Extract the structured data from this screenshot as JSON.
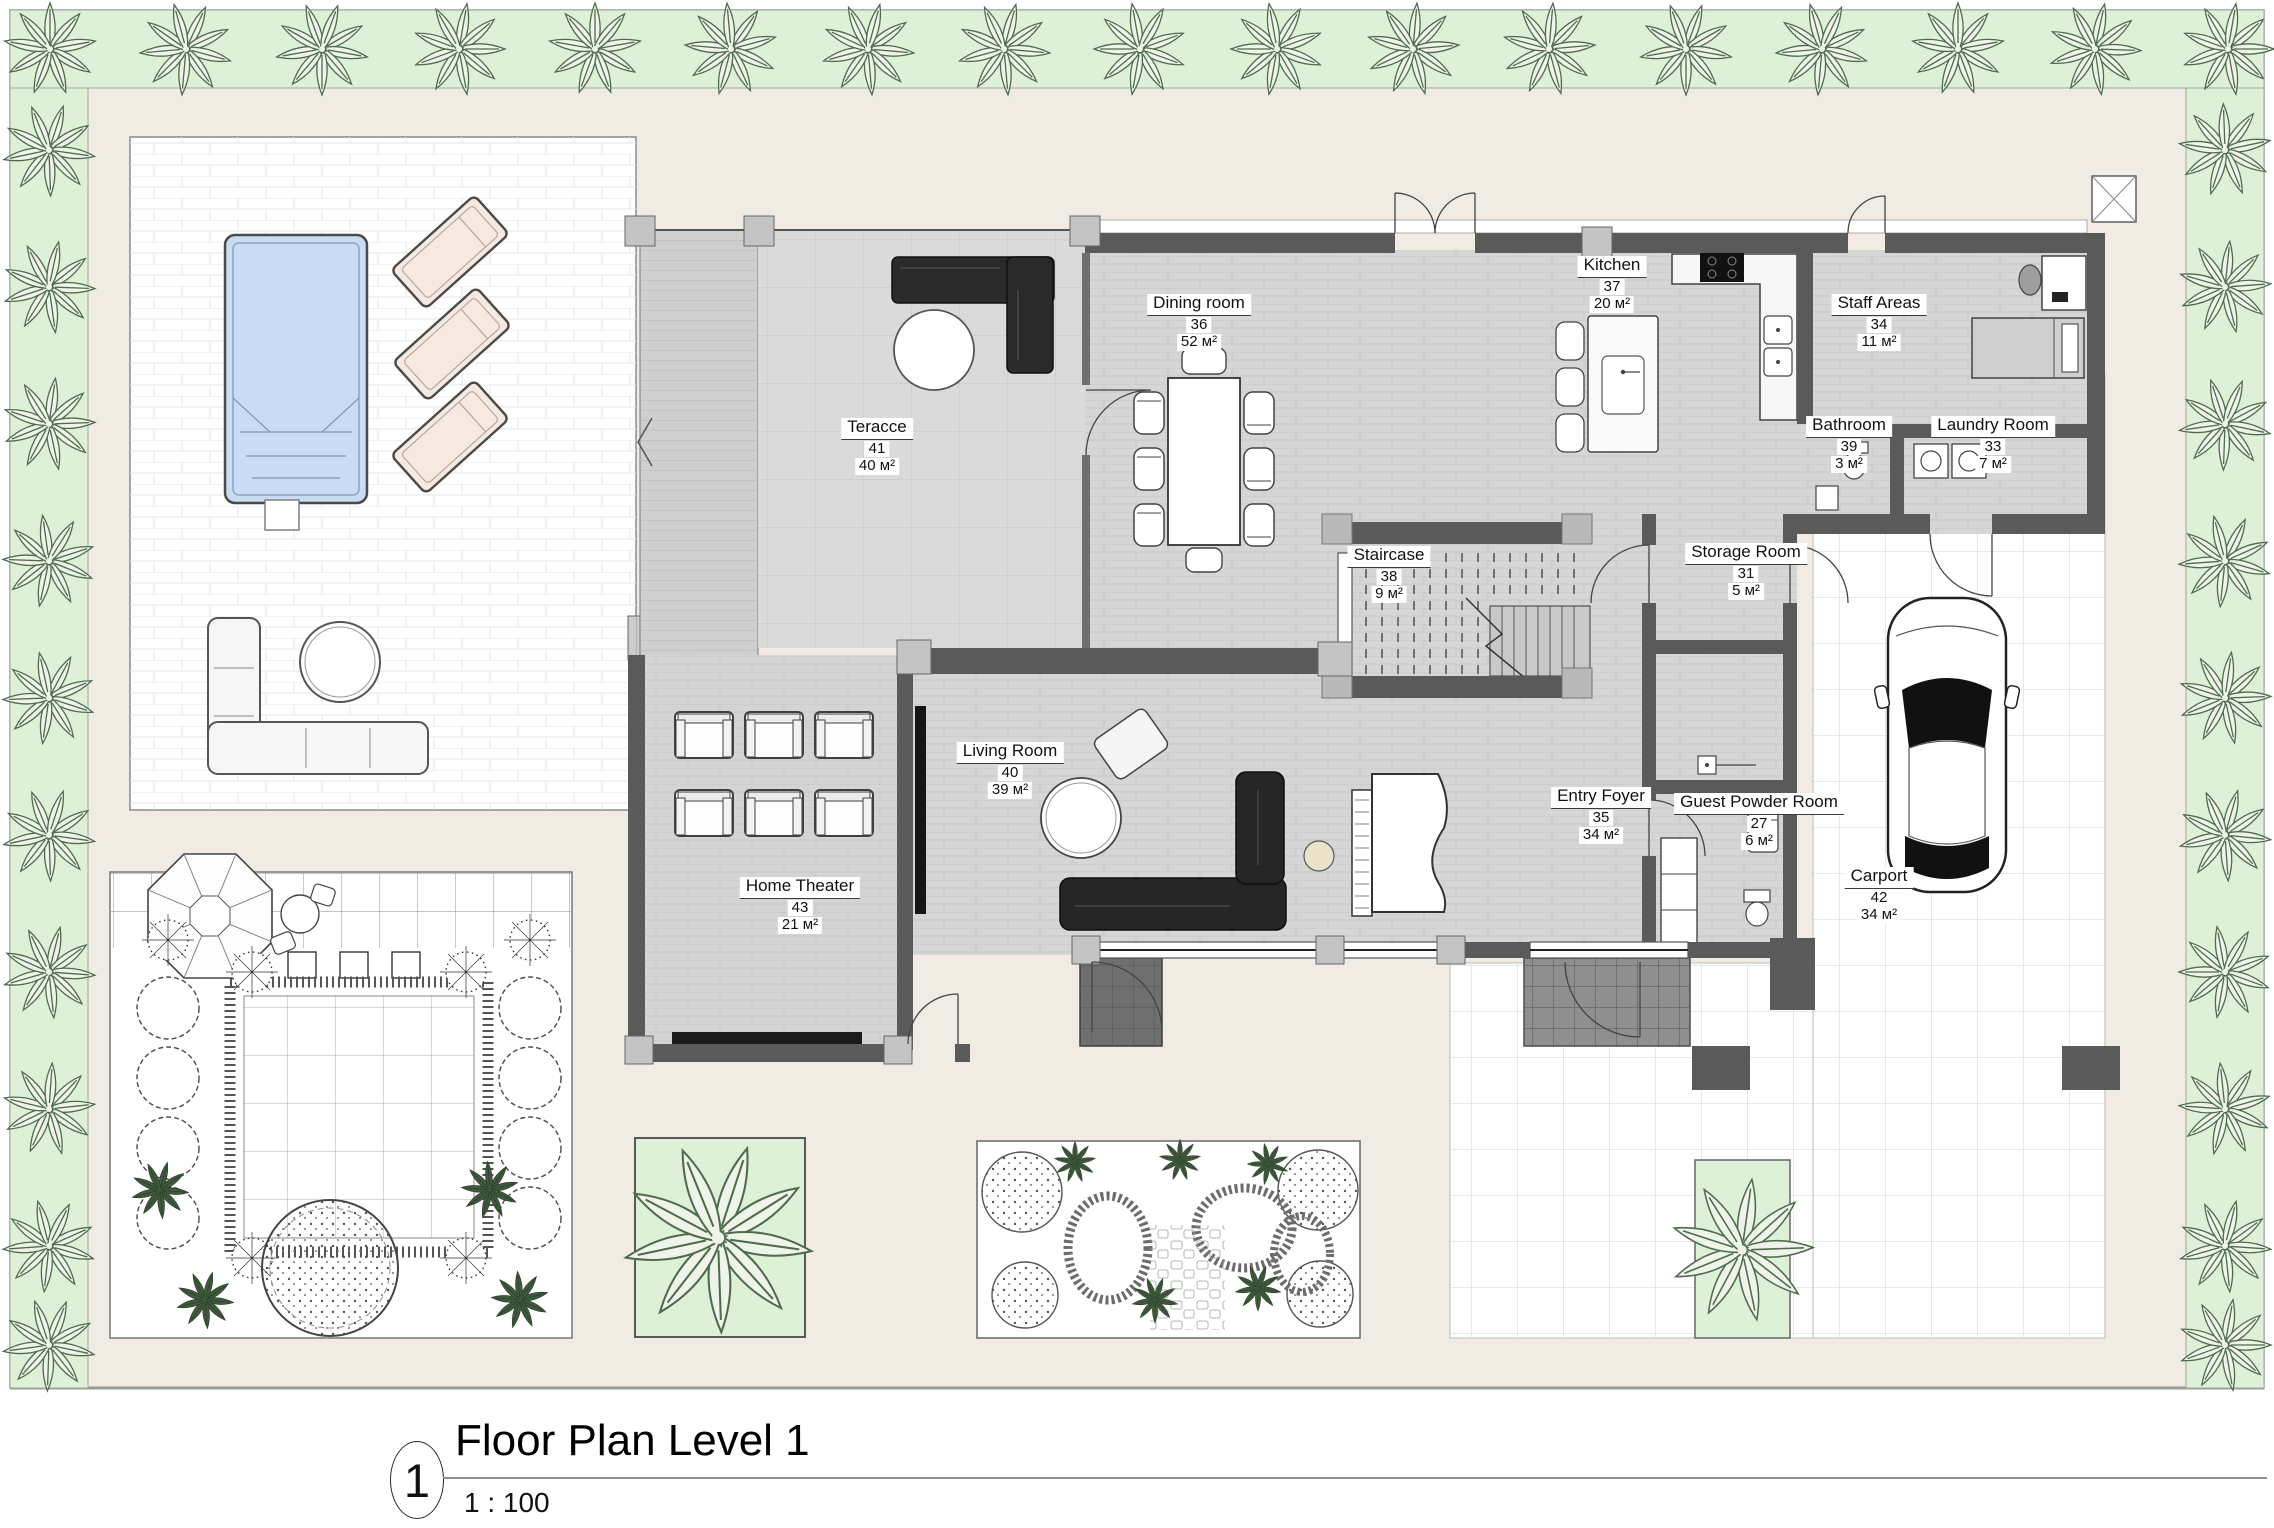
{
  "title": {
    "sheet_number": "1",
    "text": "Floor Plan Level 1",
    "scale": "1 : 100"
  },
  "area_unit": "м²",
  "rooms": [
    {
      "name": "Teracce",
      "number": "41",
      "area": "40 м²"
    },
    {
      "name": "Dining room",
      "number": "36",
      "area": "52 м²"
    },
    {
      "name": "Kitchen",
      "number": "37",
      "area": "20 м²"
    },
    {
      "name": "Staff Areas",
      "number": "34",
      "area": "11 м²"
    },
    {
      "name": "Bathroom",
      "number": "39",
      "area": "3 м²"
    },
    {
      "name": "Laundry Room",
      "number": "33",
      "area": "7 м²"
    },
    {
      "name": "Staircase",
      "number": "38",
      "area": "9 м²"
    },
    {
      "name": "Storage Room",
      "number": "31",
      "area": "5 м²"
    },
    {
      "name": "Living Room",
      "number": "40",
      "area": "39 м²"
    },
    {
      "name": "Entry Foyer",
      "number": "35",
      "area": "34 м²"
    },
    {
      "name": "Guest Powder Room",
      "number": "27",
      "area": "6 м²"
    },
    {
      "name": "Home Theater",
      "number": "43",
      "area": "21 м²"
    },
    {
      "name": "Carport",
      "number": "42",
      "area": "34 м²"
    }
  ],
  "plan_features": [
    "palm-tree-border",
    "swimming-pool",
    "sun-loungers",
    "outdoor-sofa",
    "round-table",
    "landscaped-garden",
    "garden-umbrella",
    "kitchen-island",
    "dining-table",
    "sectional-sofa",
    "grand-piano",
    "home-theater-seats",
    "staircase",
    "bed",
    "desk",
    "washer",
    "toilet",
    "car",
    "driveway",
    "entry-porch"
  ],
  "colors": {
    "plan_background": "#f0ece4",
    "border_green": "#dff0d9",
    "pool_blue": "#c9dcf3",
    "floor_gray": "#d6d6d6",
    "wall_gray": "#5a5a5a",
    "dark_furniture": "#262626",
    "lounger_beige": "#f5e9e1"
  }
}
